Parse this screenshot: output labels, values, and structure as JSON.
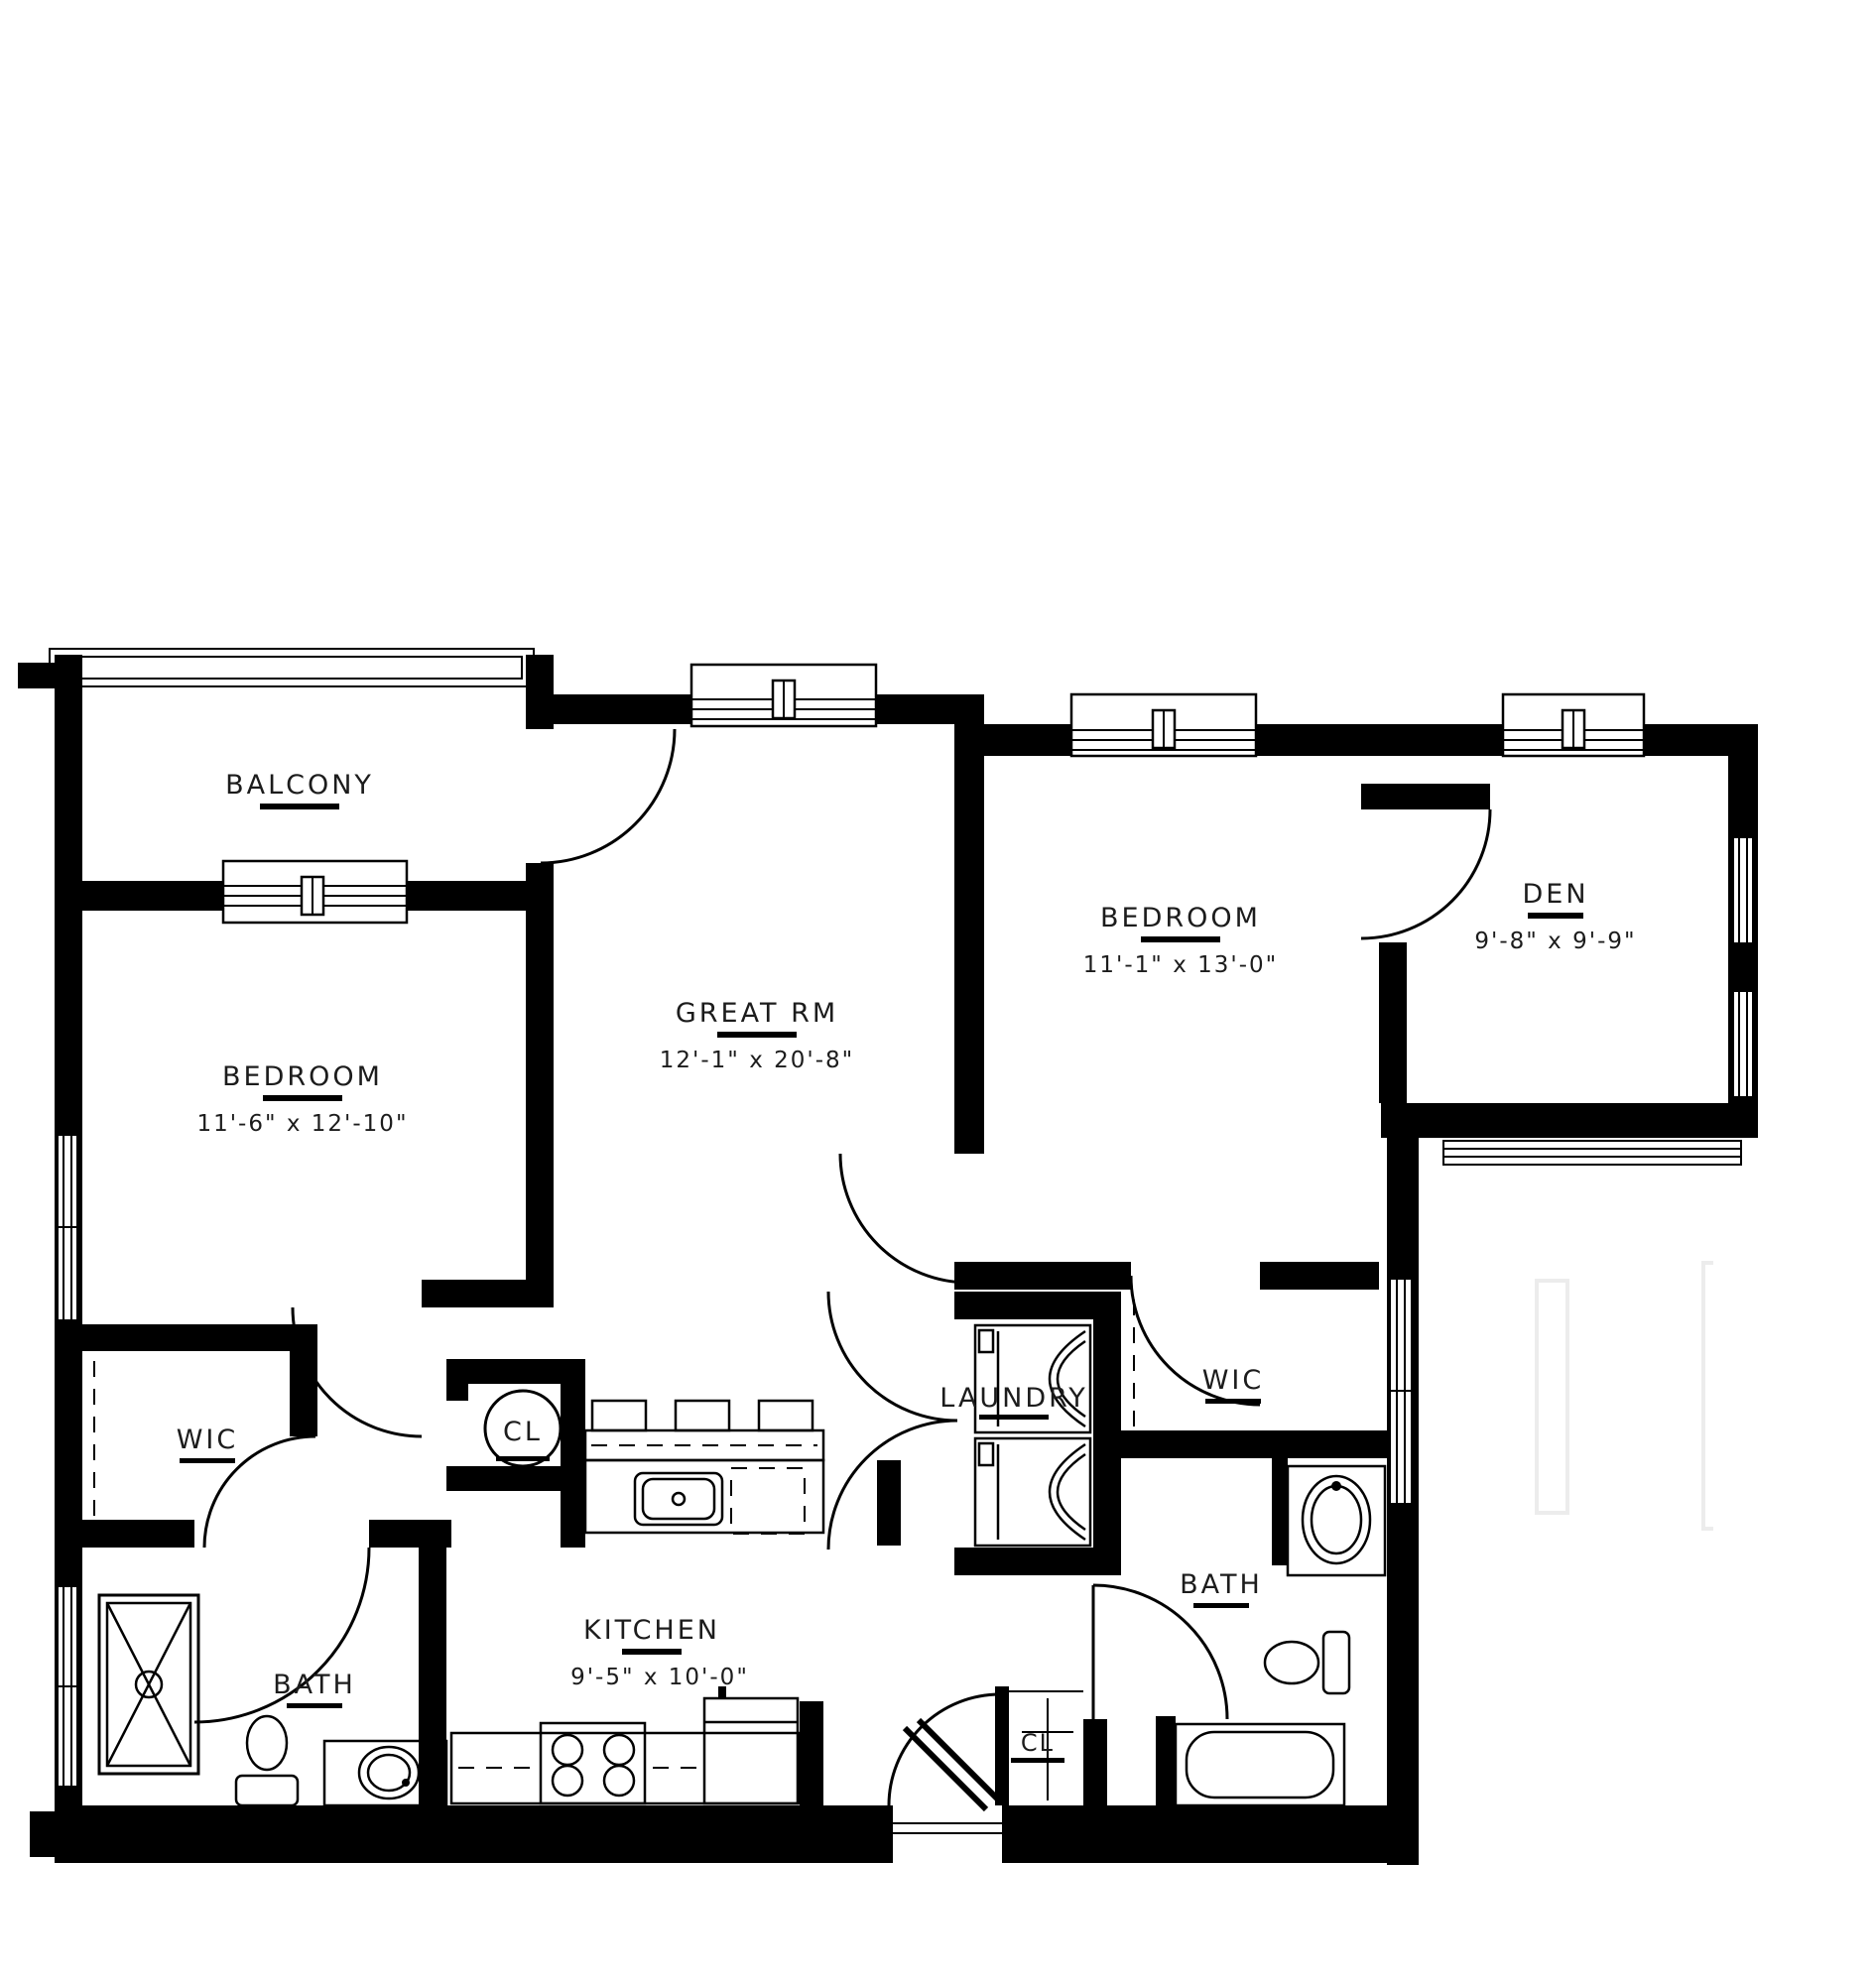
{
  "plan": {
    "type": "apartment floor plan",
    "rooms": {
      "balcony": {
        "name": "BALCONY"
      },
      "bedroom1": {
        "name": "BEDROOM",
        "dims": "11'-6\" x 12'-10\""
      },
      "great_rm": {
        "name": "GREAT RM",
        "dims": "12'-1\" x 20'-8\""
      },
      "bedroom2": {
        "name": "BEDROOM",
        "dims": "11'-1\" x 13'-0\""
      },
      "den": {
        "name": "DEN",
        "dims": "9'-8\" x 9'-9\""
      },
      "wic_left": {
        "name": "WIC"
      },
      "wic_right": {
        "name": "WIC"
      },
      "cl_center": {
        "name": "CL"
      },
      "cl_entry": {
        "name": "CL"
      },
      "laundry": {
        "name": "LAUNDRY"
      },
      "kitchen": {
        "name": "KITCHEN",
        "dims": "9'-5\" x 10'-0\""
      },
      "bath_left": {
        "name": "BATH"
      },
      "bath_right": {
        "name": "BATH"
      }
    },
    "colors": {
      "wall": "#000000",
      "text": "#1c1c1c",
      "faint_neighbor_lines": "#ececec",
      "background": "#ffffff"
    }
  }
}
